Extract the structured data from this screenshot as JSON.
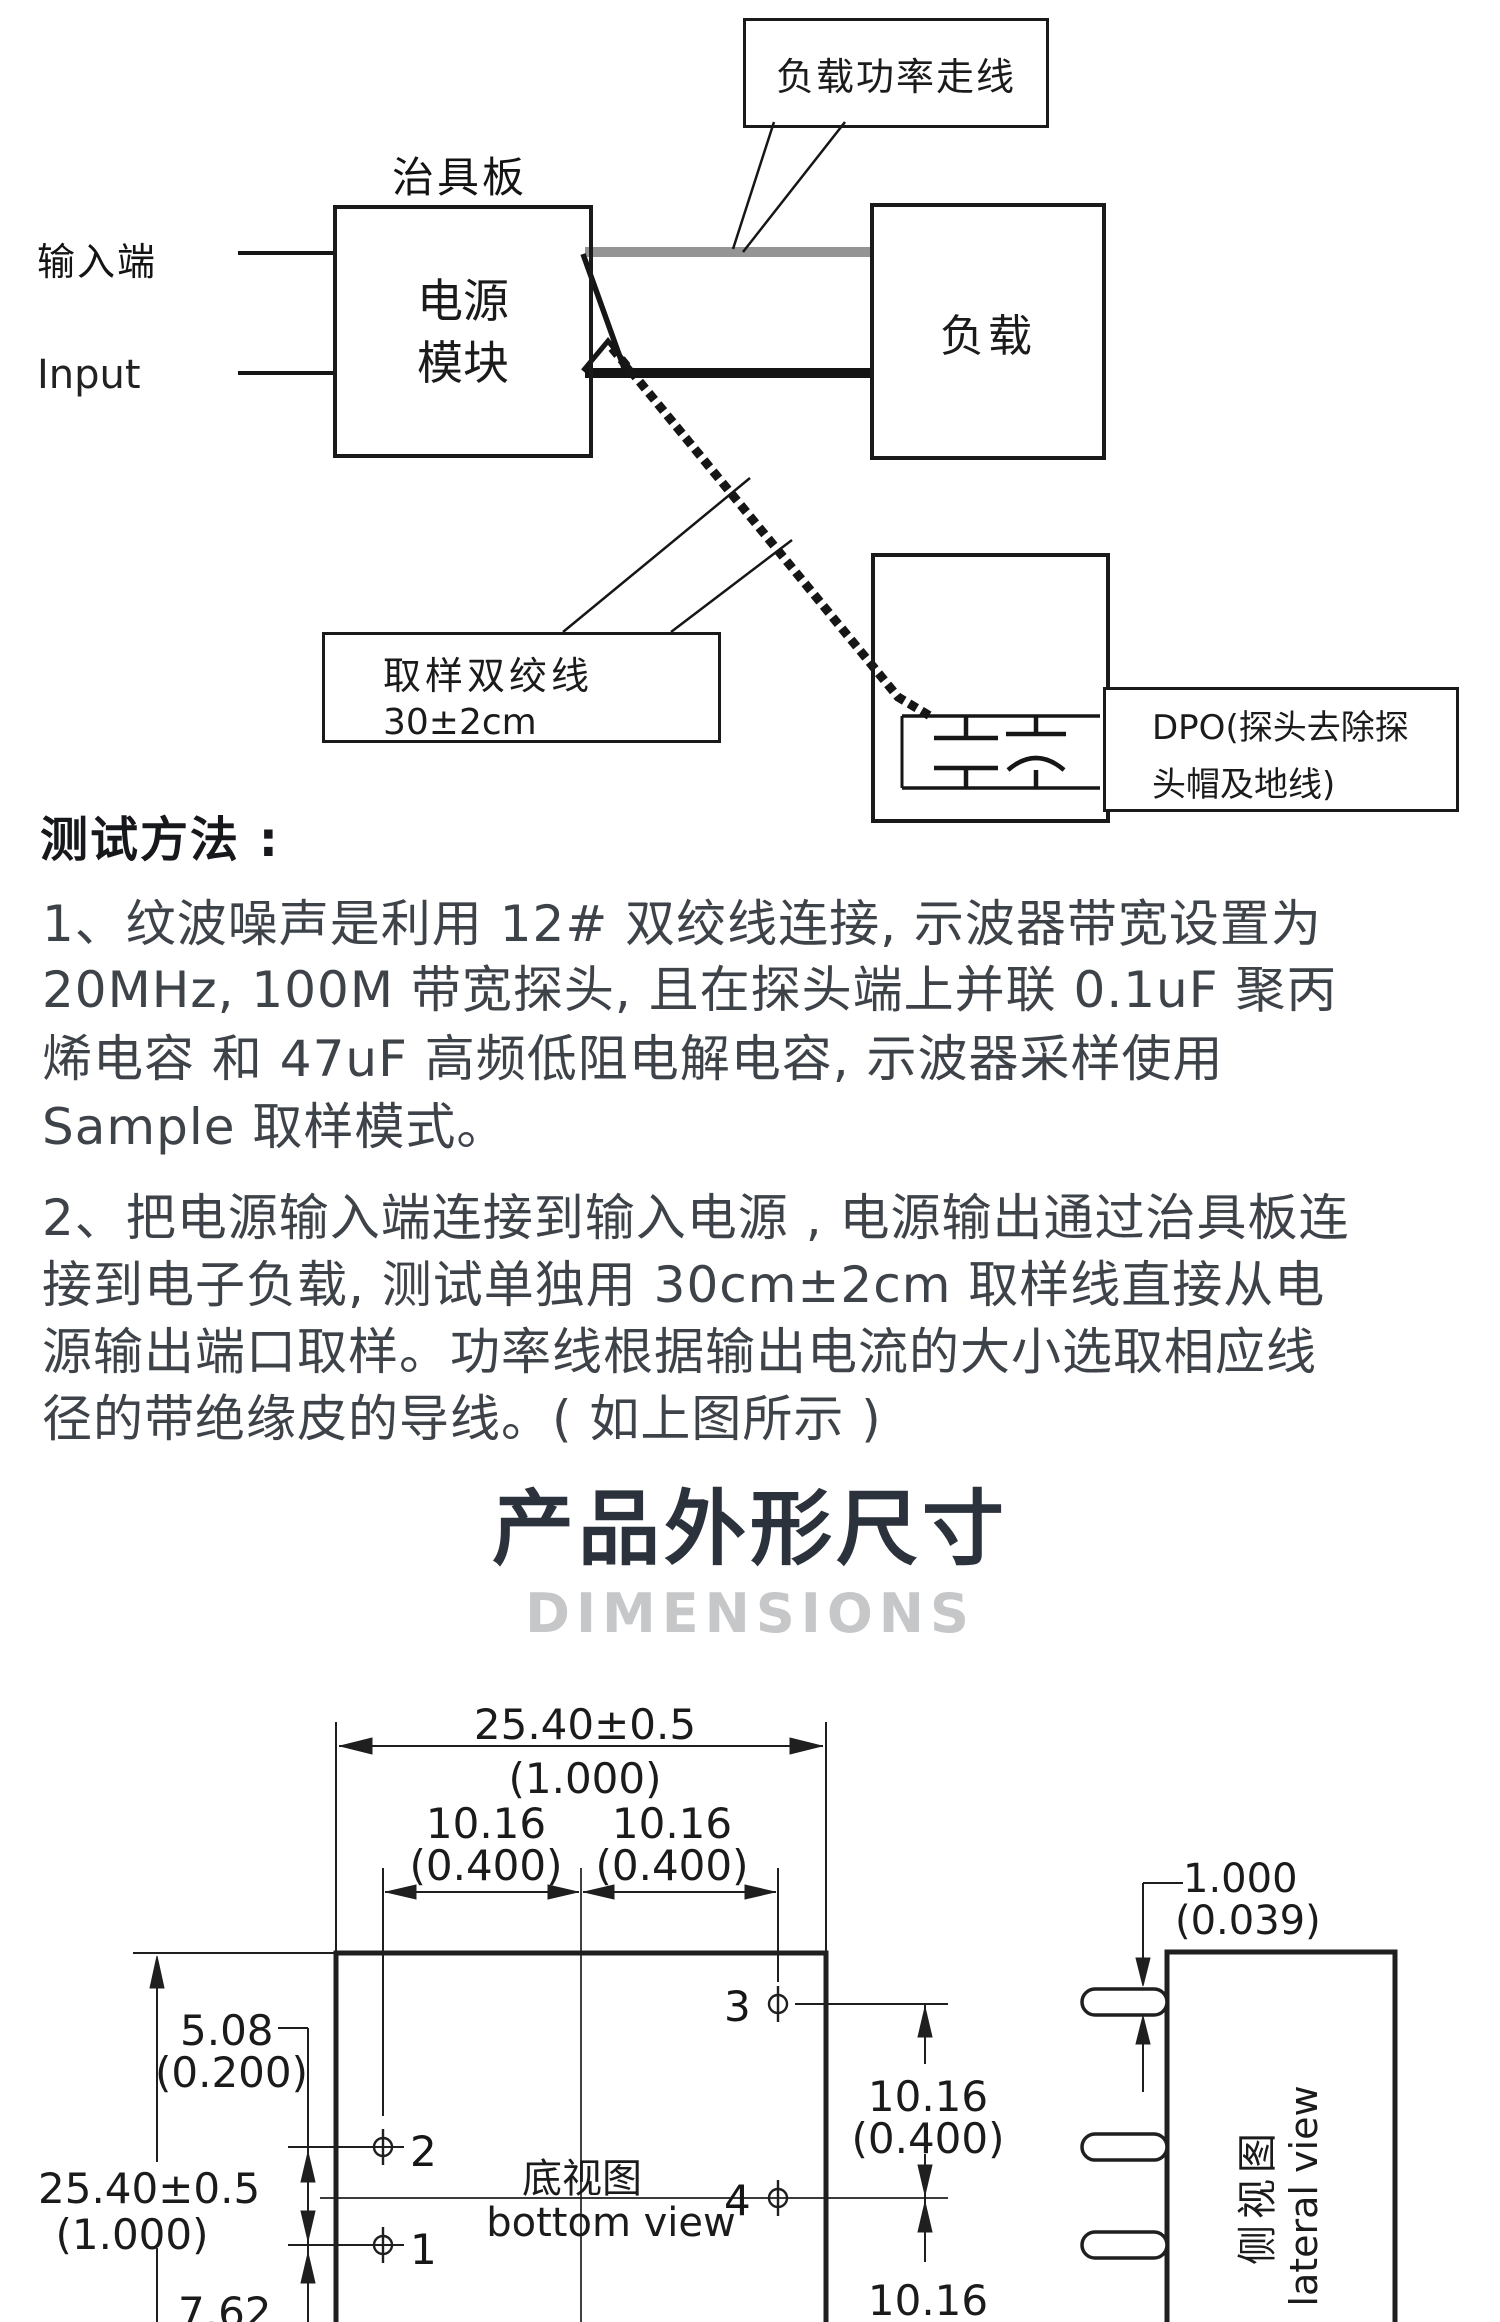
{
  "diagram": {
    "callout_load_trace": "负载功率走线",
    "fixture_board": "治具板",
    "input_zh": "输入端",
    "input_en": "Input",
    "power_module_line1": "电源",
    "power_module_line2": "模块",
    "load": "负载",
    "sample_wire_line1": "取样双绞线",
    "sample_wire_line2": "30±2cm",
    "dpo_line1": "DPO(探头去除探",
    "dpo_line2": "头帽及地线)"
  },
  "test_method": {
    "heading": "测试方法 :",
    "item1_lines": [
      "1、纹波噪声是利用 12# 双绞线连接, 示波器带宽设置为",
      "20MHz, 100M 带宽探头, 且在探头端上并联 0.1uF 聚丙",
      "烯电容 和 47uF 高频低阻电解电容, 示波器采样使用",
      "Sample 取样模式。"
    ],
    "item2_lines": [
      "2、把电源输入端连接到输入电源 , 电源输出通过治具板连",
      "接到电子负载, 测试单独用 30cm±2cm 取样线直接从电",
      "源输出端口取样。功率线根据输出电流的大小选取相应线",
      "径的带绝缘皮的导线。( 如上图所示 )"
    ]
  },
  "dimensions": {
    "title_zh": "产品外形尺寸",
    "title_en": "DIMENSIONS",
    "title_color": "#2b323c",
    "subtitle_color": "#c5c7c9",
    "bottom_view": {
      "label_zh": "底视图",
      "label_en": "bottom view",
      "width_mm": "25.40±0.5",
      "width_in": "(1.000)",
      "pitch_left_mm": "10.16",
      "pitch_left_in": "(0.400)",
      "pitch_right_mm": "10.16",
      "pitch_right_in": "(0.400)",
      "height_mm": "25.40±0.5",
      "height_in": "(1.000)",
      "offset_mm": "5.08",
      "offset_in": "(0.200)",
      "bottom_offset_mm": "7.62",
      "right_pitch_mm": "10.16",
      "right_pitch_in": "(0.400)",
      "right_pitch2_mm": "10.16",
      "right_pitch2_in": "(0.400)",
      "pin1": "1",
      "pin2": "2",
      "pin3": "3",
      "pin4": "4"
    },
    "lateral_view": {
      "label_zh": "侧视图",
      "label_en": "lateral view",
      "pin_mm": "1.000",
      "pin_in": "(0.039)"
    }
  }
}
